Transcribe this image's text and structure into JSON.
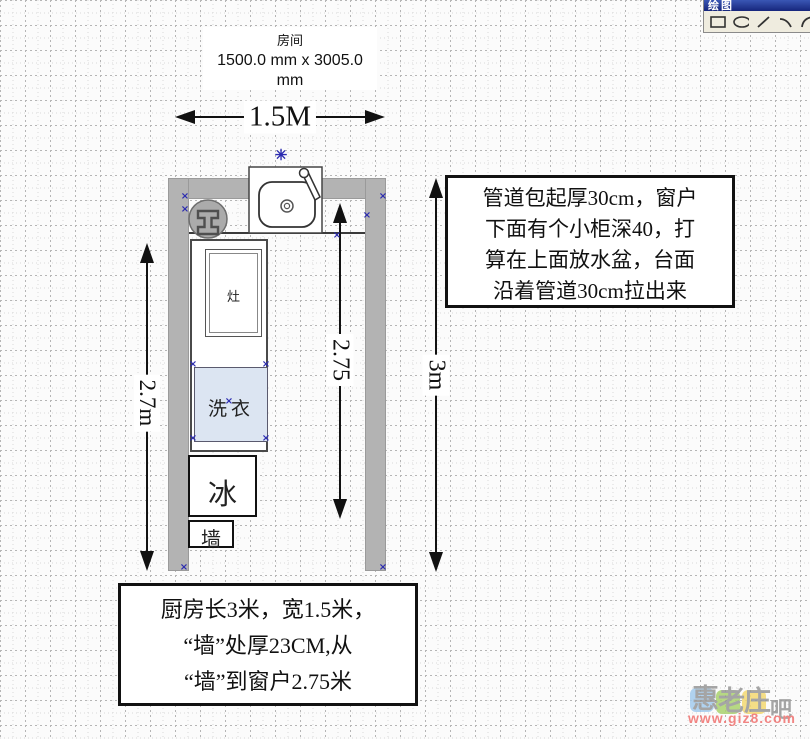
{
  "title_block": {
    "name": "房间",
    "size_line1": "1500.0 mm x 3005.0",
    "size_line2": "mm"
  },
  "dimensions": {
    "width": "1.5M",
    "left_height": "2.7m",
    "window_to_wall": "2.75",
    "right_height": "3m"
  },
  "fixtures": {
    "stove": "灶",
    "washer": "洗衣",
    "fridge": "冰",
    "wall_label": "墙"
  },
  "right_note": {
    "lines": [
      "管道包起厚30cm，窗户",
      "下面有个小柜深40，打",
      "算在上面放水盆，台面",
      "沿着管道30cm拉出来"
    ]
  },
  "bottom_note": {
    "lines": [
      "厨房长3米，宽1.5米，",
      "“墙”处厚23CM,从",
      "“墙”到窗户2.75米"
    ]
  },
  "toolbar": {
    "title": "绘图",
    "tools": [
      "rectangle",
      "ellipse",
      "line",
      "arc",
      "arc-2"
    ]
  },
  "watermark": {
    "tiles": [
      {
        "char": "惠",
        "color": "#a3cbee"
      },
      {
        "char": "老",
        "color": "#abd36f"
      },
      {
        "char": "庄",
        "color": "#f4da72"
      }
    ],
    "suffix": "吧",
    "url": "www.giz8.com"
  },
  "colors": {
    "wall_gray": "#b3b3b3",
    "washer_fill": "#dce5f2",
    "selection_blue": "#2b2bb0",
    "url_red": "#f0716f"
  }
}
